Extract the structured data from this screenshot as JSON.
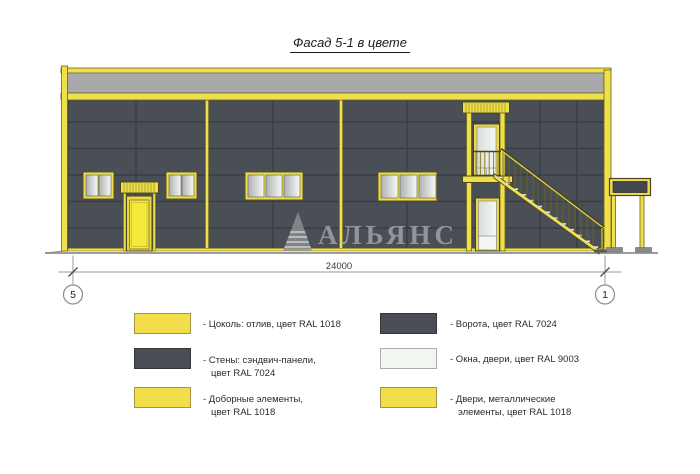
{
  "title": "Фасад 5-1 в цвете",
  "watermark": "АЛЬЯНС",
  "dimension_label": "24000",
  "axis_markers": {
    "left": "5",
    "right": "1"
  },
  "legend": {
    "left": [
      {
        "swatch": "#F2DE4A",
        "line1": "- Цоколь: отлив, цвет RAL 1018",
        "line2": ""
      },
      {
        "swatch": "#4A4E54",
        "line1": "- Стены: сэндвич-панели,",
        "line2": "цвет RAL 7024"
      },
      {
        "swatch": "#F2DE4A",
        "line1": "- Доборные элементы,",
        "line2": "цвет RAL 1018"
      }
    ],
    "right": [
      {
        "swatch": "#4A4E54",
        "line1": "- Ворота, цвет RAL 7024",
        "line2": ""
      },
      {
        "swatch": "#F2F6F1",
        "line1": "- Окна, двери, цвет RAL 9003",
        "line2": ""
      },
      {
        "swatch": "#F2DE4A",
        "line1": "- Двери, металлические",
        "line2": "элементы, цвет RAL 1018"
      }
    ]
  },
  "colors": {
    "accent_yellow": "#F2DE4A",
    "wall_gray": "#4A4E54",
    "parapet_gray": "#A9A9A9",
    "window_white": "#F2F6F1"
  }
}
